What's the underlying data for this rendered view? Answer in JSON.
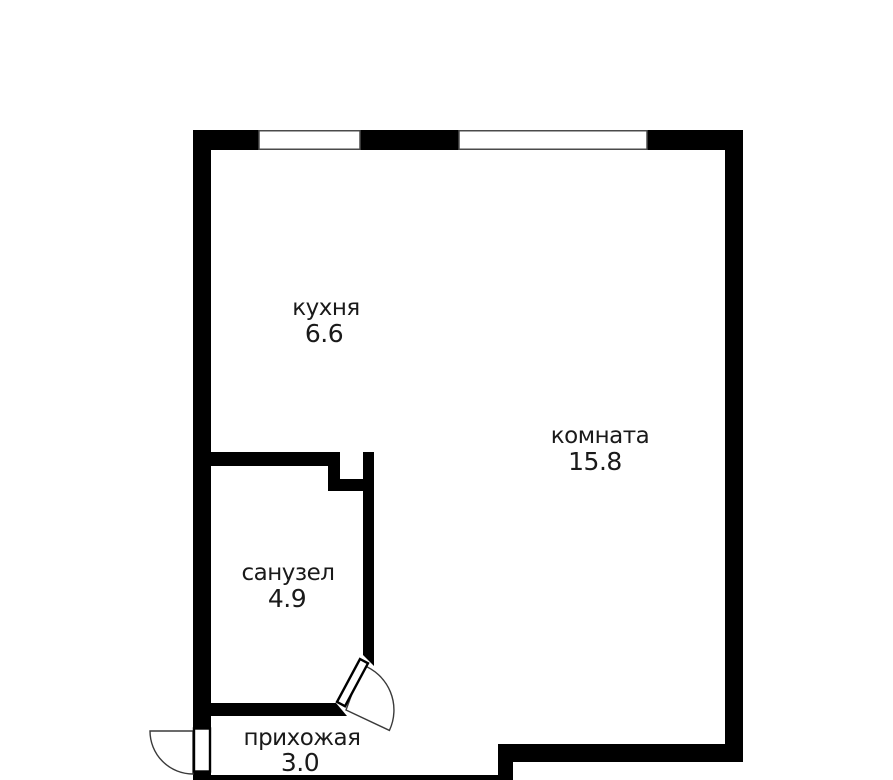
{
  "plan": {
    "title": "apartment floor plan",
    "wall_color": "#000000",
    "text_color": "#1a1a1a",
    "background_color": "#ffffff",
    "rooms": [
      {
        "id": "kitchen",
        "name": "кухня",
        "area": "6.6"
      },
      {
        "id": "room",
        "name": "комната",
        "area": "15.8"
      },
      {
        "id": "bathroom",
        "name": "санузел",
        "area": "4.9"
      },
      {
        "id": "hallway",
        "name": "прихожая",
        "area": "3.0"
      }
    ]
  }
}
